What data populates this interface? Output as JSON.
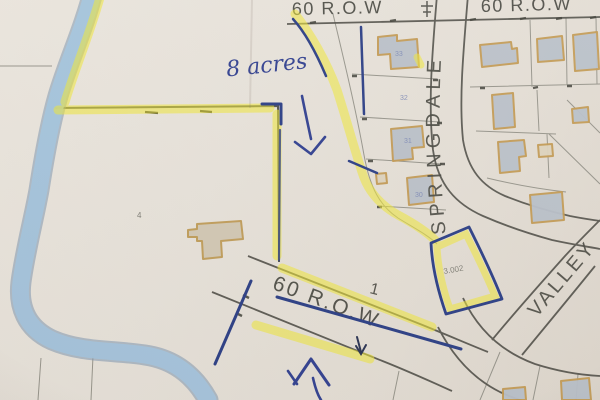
{
  "scene": {
    "description": "Photographed paper plat map with highlighter and pen markup",
    "paper_color": "#e8e3db"
  },
  "labels": {
    "row_top_left": "60 R.O.W",
    "row_top_right": "60 R.O.W",
    "row_mid": "60 R.O.W",
    "springdale": "SPRINGDALE",
    "valley": "VALLEY",
    "acres_note": "8 acres",
    "wedge_area": "3.002",
    "lot_numbers": [
      "33",
      "32",
      "31",
      "30"
    ],
    "lot_1": "1",
    "ref_4": "4"
  },
  "annotations": {
    "down_arrow": "hand-drawn blue pen arrow pointing down into 8-acre parcel",
    "up_arrow": "hand-drawn blue pen arrow pointing up at road parcel",
    "small_arrow": "small pen arrow below middle road",
    "pole_symbol": "small survey/utility symbol on top road"
  },
  "colors": {
    "highlighter_yellow": "#f0e83a",
    "creek_marker_blue": "#a7c6de",
    "creek_edge_blue": "#7f98b0",
    "pen_navy": "#2c3f85",
    "ink_blue": "#32418f",
    "map_line_gray": "#8a887f",
    "road_line_dark": "#4f4e47",
    "house_outline_tan": "#c29a55",
    "house_fill_gray": "#b9c0c9",
    "paper": "#e8e3db"
  }
}
